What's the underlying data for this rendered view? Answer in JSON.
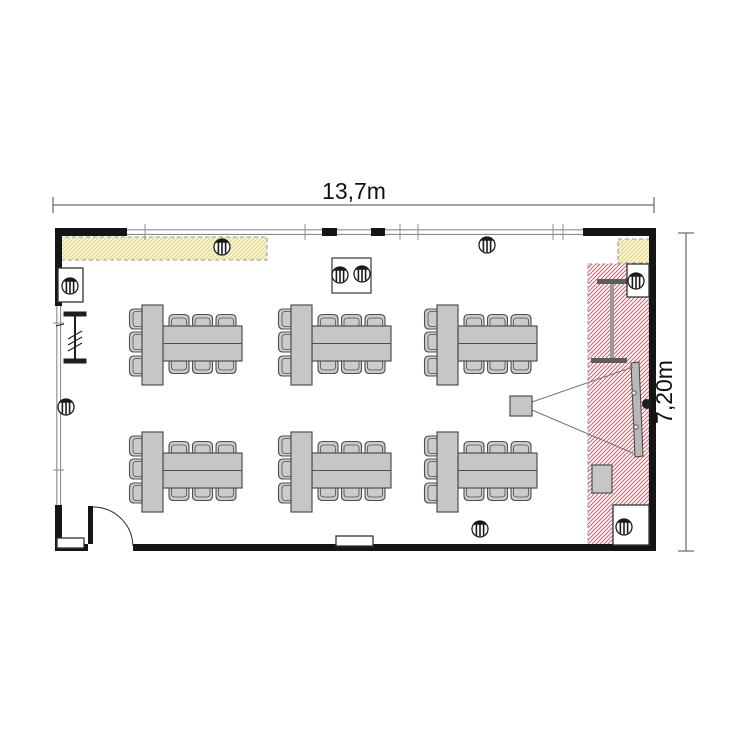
{
  "dimensions": {
    "width_label": "13,7m",
    "height_label": "7,20m"
  },
  "colors": {
    "background": "#ffffff",
    "wall": "#151515",
    "furniture_fill": "#c6c6c6",
    "chair_fill": "#cbcbcb",
    "furniture_stroke": "#4f4f4f",
    "window_line": "#8c8c8c",
    "red_hatch_stripe": "#c4636f",
    "yellow_fill": "#faf6da",
    "yellow_stripe": "#ded37e",
    "hatch_border": "#9a9a9a",
    "screen_fill": "#b8b8b8",
    "stand_dark": "#5c5c5c",
    "stand_light": "#9a9a9a",
    "dim_line": "#4a4a4a",
    "text": "#111111"
  },
  "furniture": {
    "table_groups": 6,
    "rows": 2,
    "groups_per_row": 3,
    "chairs_per_group": 9,
    "ceiling_lights": 9
  }
}
